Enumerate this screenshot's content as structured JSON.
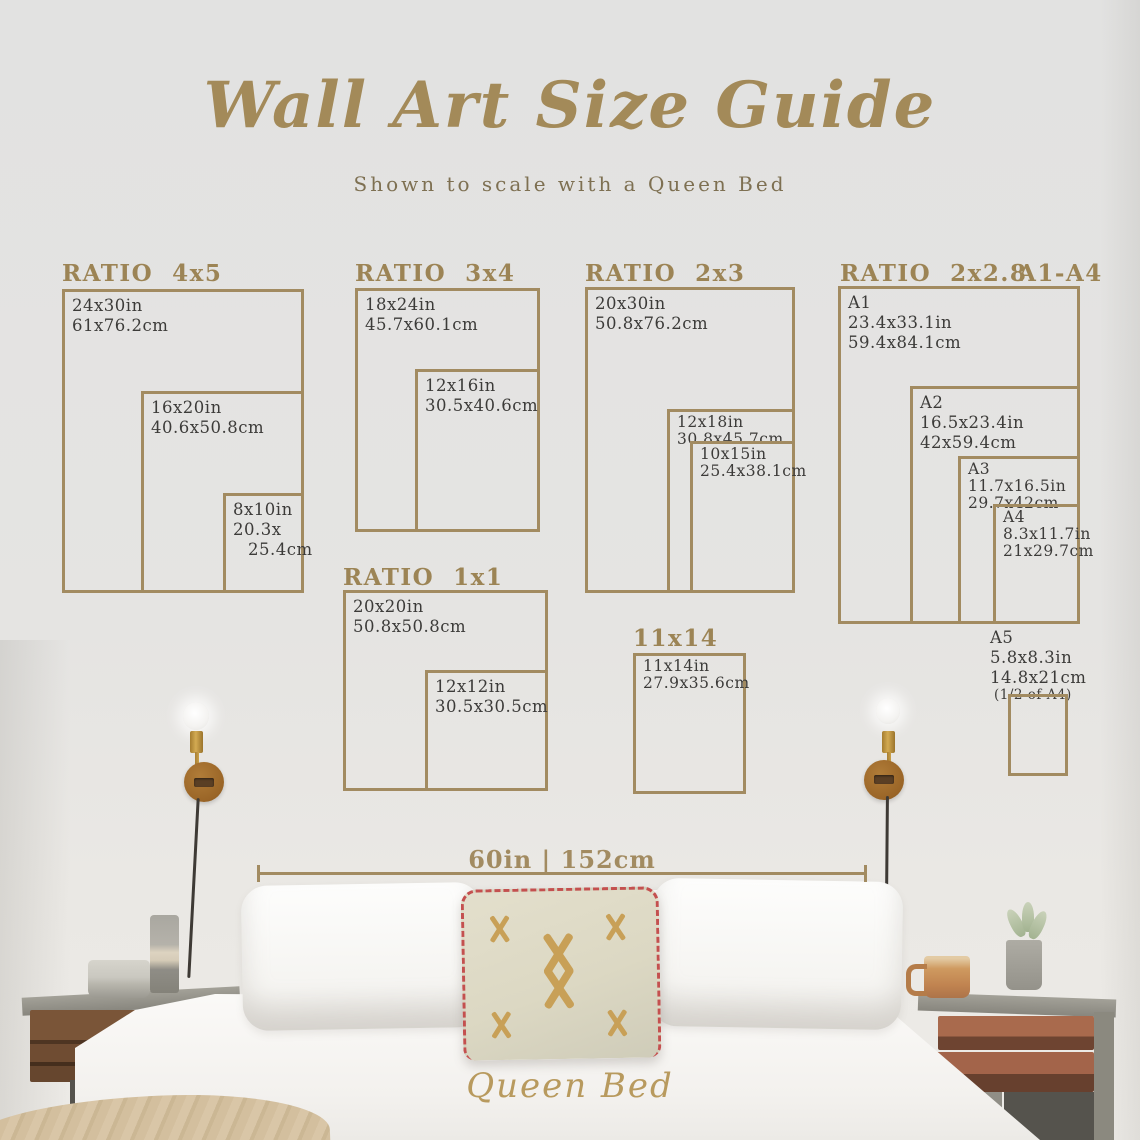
{
  "title": "Wall Art Size Guide",
  "subtitle": "Shown to scale with a Queen Bed",
  "colors": {
    "accent_gold": "#a28b61",
    "header_gold": "#9c8455",
    "text_dark": "#3c3b39",
    "trim_red": "#c4504f",
    "wall": "#e5e4e2"
  },
  "groups": {
    "r4x5": {
      "header": "RATIO  4x5",
      "boxes": [
        {
          "in": "24x30in",
          "cm": "61x76.2cm"
        },
        {
          "in": "16x20in",
          "cm": "40.6x50.8cm"
        },
        {
          "in": "8x10in",
          "cm": "20.3x",
          "cm2": "25.4cm"
        }
      ]
    },
    "r3x4": {
      "header": "RATIO  3x4",
      "boxes": [
        {
          "in": "18x24in",
          "cm": "45.7x60.1cm"
        },
        {
          "in": "12x16in",
          "cm": "30.5x40.6cm"
        }
      ]
    },
    "r2x3": {
      "header": "RATIO  2x3",
      "boxes": [
        {
          "in": "20x30in",
          "cm": "50.8x76.2cm"
        },
        {
          "in": "12x18in",
          "cm": "30.8x45.7cm"
        },
        {
          "in": "10x15in",
          "cm": "25.4x38.1cm"
        }
      ]
    },
    "r1x1": {
      "header": "RATIO  1x1",
      "boxes": [
        {
          "in": "20x20in",
          "cm": "50.8x50.8cm"
        },
        {
          "in": "12x12in",
          "cm": "30.5x30.5cm"
        }
      ]
    },
    "r11x14": {
      "header": "11x14",
      "boxes": [
        {
          "in": "11x14in",
          "cm": "27.9x35.6cm"
        }
      ]
    },
    "aseries": {
      "header": "RATIO  2x2.8",
      "header2": "A1-A4",
      "boxes": [
        {
          "name": "A1",
          "in": "23.4x33.1in",
          "cm": "59.4x84.1cm"
        },
        {
          "name": "A2",
          "in": "16.5x23.4in",
          "cm": "42x59.4cm"
        },
        {
          "name": "A3",
          "in": "11.7x16.5in",
          "cm": "29.7x42cm"
        },
        {
          "name": "A4",
          "in": "8.3x11.7in",
          "cm": "21x29.7cm"
        }
      ],
      "a5": {
        "name": "A5",
        "in": "5.8x8.3in",
        "cm": "14.8x21cm",
        "note": "(1/2 of A4)"
      }
    }
  },
  "measurement": {
    "label": "60in | 152cm"
  },
  "bed_label": "Queen Bed"
}
